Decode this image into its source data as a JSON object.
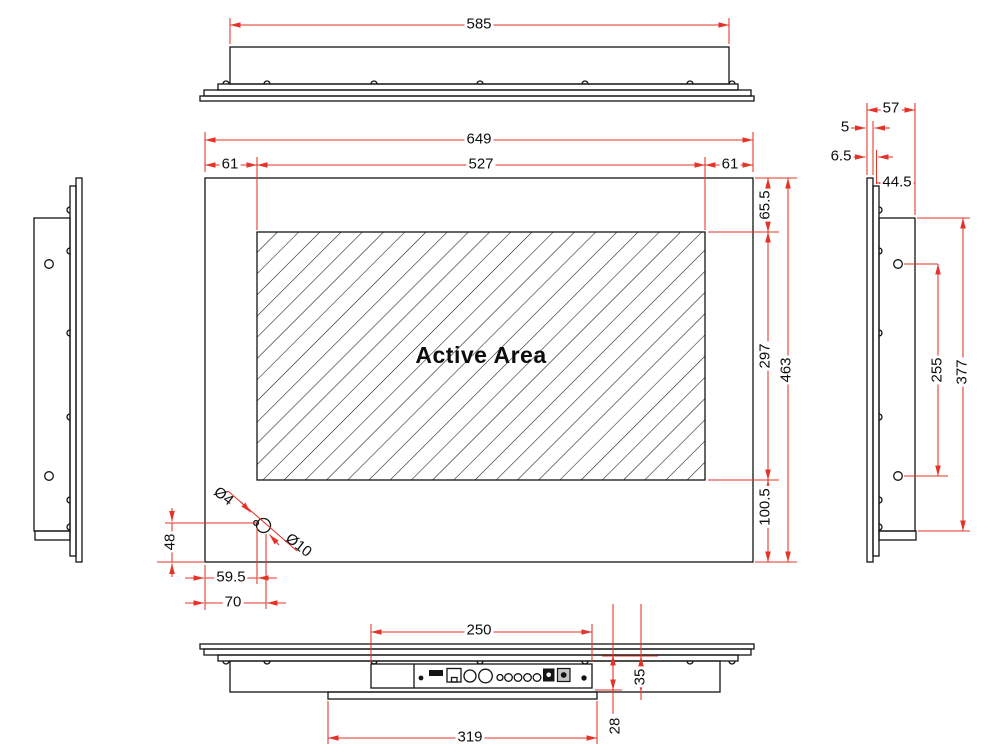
{
  "views": {
    "top": {
      "dim_enclosure_width": "585"
    },
    "front": {
      "active_area_label": "Active Area",
      "dim_overall_width": "649",
      "dim_active_width": "527",
      "dim_bezel_left": "61",
      "dim_bezel_right": "61",
      "dim_bezel_top": "65.5",
      "dim_active_height": "297",
      "dim_overall_height": "463",
      "dim_bezel_bottom": "100.5",
      "dim_hole_small_dia": "Ø4",
      "dim_hole_large_dia": "Ø10",
      "dim_hole_from_bottom": "48",
      "dim_hole_from_left_inner": "59.5",
      "dim_hole_from_left_outer": "70"
    },
    "right_side": {
      "dim_total_depth": "57",
      "dim_glass_thickness": "5",
      "dim_front_offset": "6.5",
      "dim_rear_depth": "44.5",
      "dim_hole_spacing": "255",
      "dim_enclosure_height": "377"
    },
    "bottom": {
      "dim_io_cutout_width": "250",
      "dim_cover_plate_width": "319",
      "dim_rear_depth": "35",
      "dim_cover_offset": "28"
    }
  },
  "colors": {
    "dimension": "#e63327",
    "outline": "#141414",
    "background": "#ffffff"
  }
}
